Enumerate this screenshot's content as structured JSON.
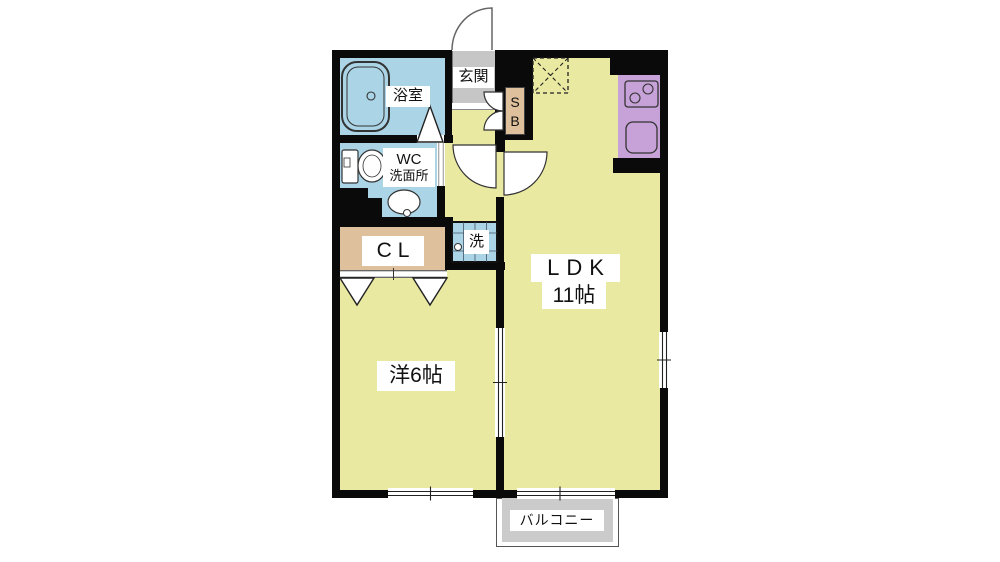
{
  "plan": {
    "rooms": {
      "bathroom": {
        "label": "浴室"
      },
      "washroom": {
        "label_line1": "WC",
        "label_line2": "洗面所"
      },
      "entrance": {
        "label": "玄関"
      },
      "shoe_box": {
        "label": "S\nB"
      },
      "closet": {
        "label": "CL"
      },
      "laundry": {
        "label": "洗"
      },
      "ldk": {
        "label": "LDK",
        "size": "11帖"
      },
      "western_room": {
        "label": "洋6帖"
      },
      "balcony": {
        "label": "バルコニー"
      }
    },
    "colors": {
      "room_floor": "#e9e9a2",
      "wet_area_floor": "#abd4e6",
      "storage_fill": "#dec09c",
      "kitchen_counter": "#c7a2d8",
      "entrance_floor": "#c6c6c6",
      "balcony_floor": "#cbcbcb",
      "wall": "#0a0a0a"
    }
  }
}
